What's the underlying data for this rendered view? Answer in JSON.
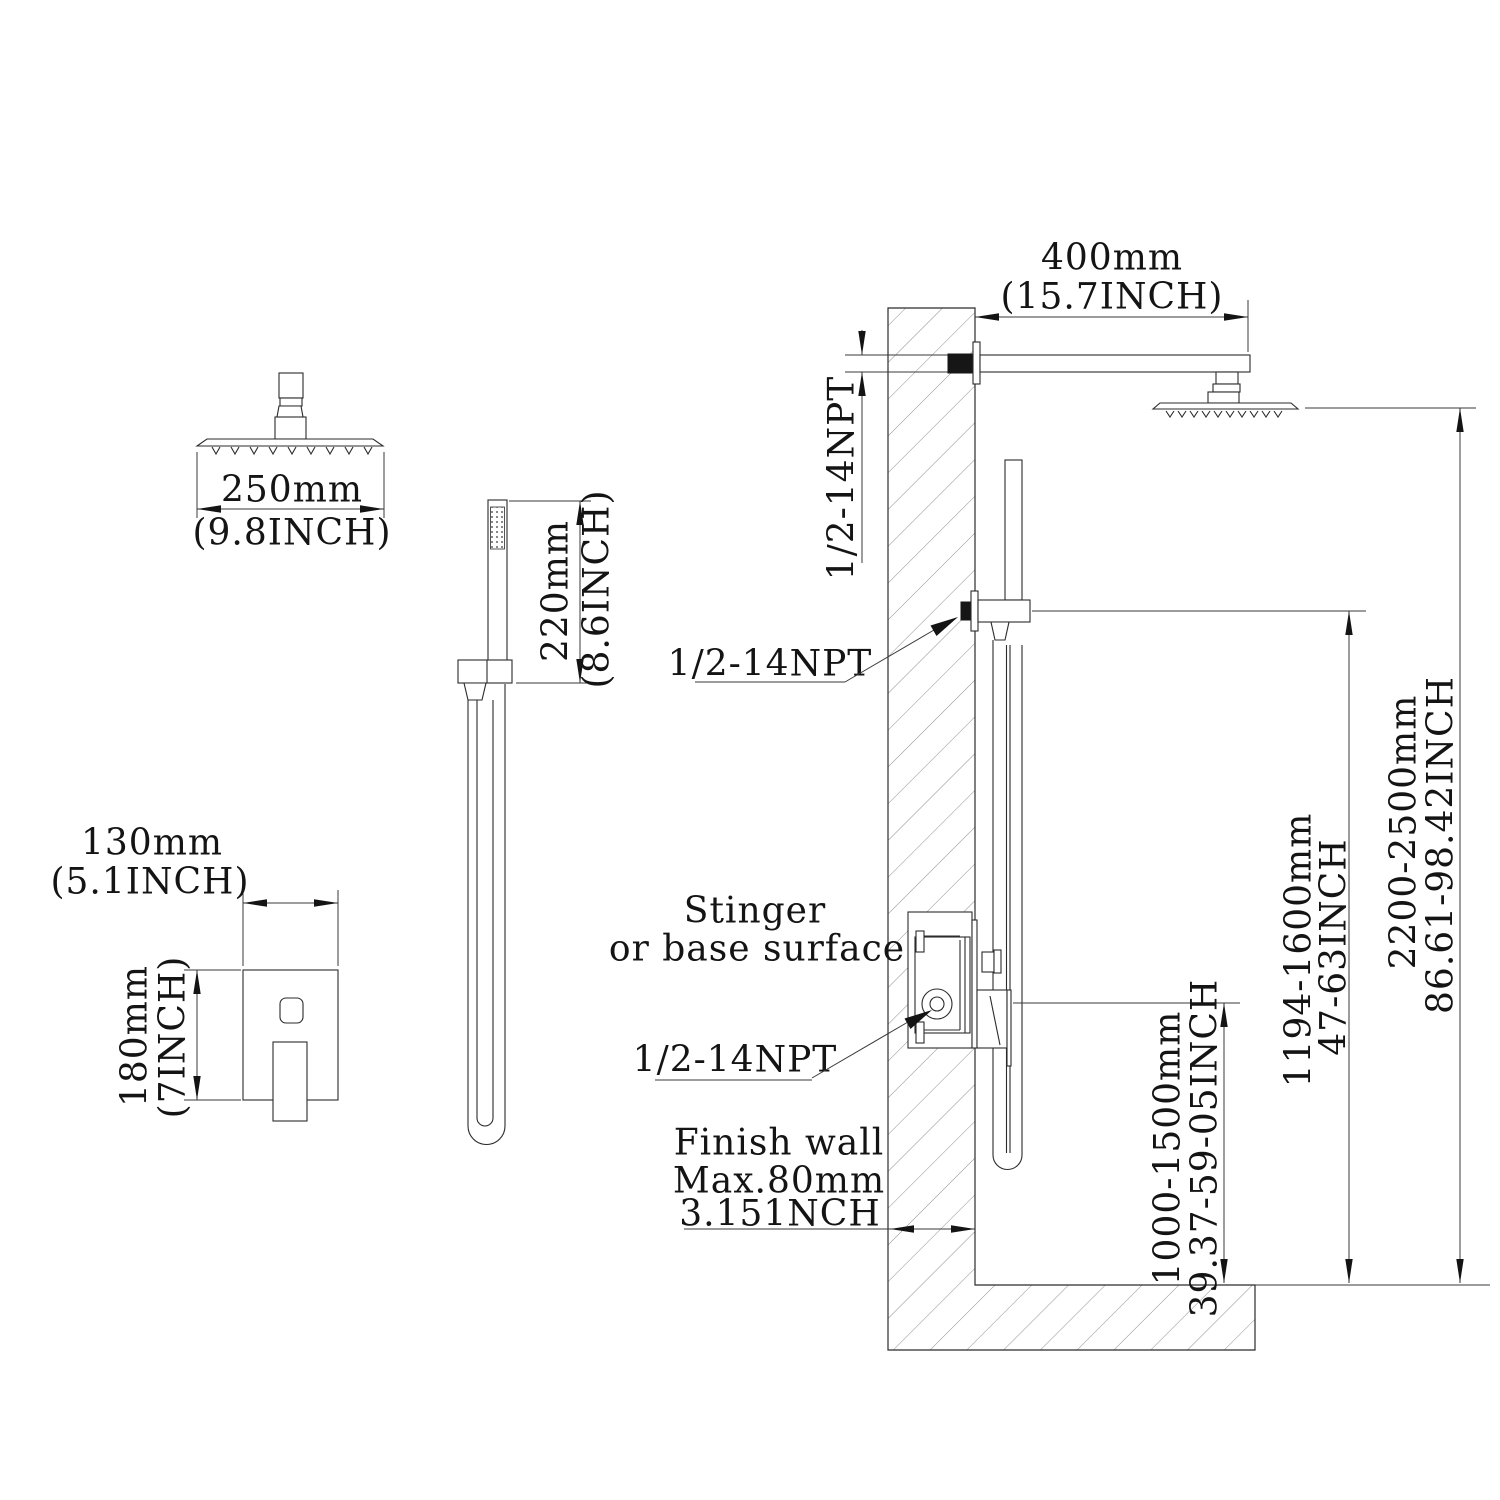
{
  "title": "Shower system installation dimension diagram",
  "colors": {
    "background": "#ffffff",
    "line": "#2b2b2b",
    "dimension": "#3a3a3a",
    "hatch": "#8f8f8f",
    "thread_fill": "#161616"
  },
  "views": {
    "showerhead_front": {
      "width_mm": "250mm",
      "width_inch": "(9.8INCH)"
    },
    "handshower_front": {
      "height_mm": "220mm",
      "height_inch": "(8.6INCH)"
    },
    "valve_front": {
      "width_mm": "130mm",
      "width_inch": "(5.1INCH)",
      "height_mm": "180mm",
      "height_inch": "(7INCH)"
    },
    "installation": {
      "arm_length_mm": "400mm",
      "arm_length_inch": "(15.7INCH)",
      "arm_thread": "1/2-14NPT",
      "outlet_thread": "1/2-14NPT",
      "valve_thread": "1/2-14NPT",
      "note_line1": "Stinger",
      "note_line2": "or base surface",
      "finish_wall_line1": "Finish wall",
      "finish_wall_line2": "Max.80mm",
      "finish_wall_line3": "3.151NCH",
      "valve_height_mm": "1000-1500mm",
      "valve_height_inch": "39.37-59-05INCH",
      "holder_height_mm": "1194-1600mm",
      "holder_height_inch": "47-63INCH",
      "head_height_mm": "2200-2500mm",
      "head_height_inch": "86.61-98.42INCH"
    }
  }
}
